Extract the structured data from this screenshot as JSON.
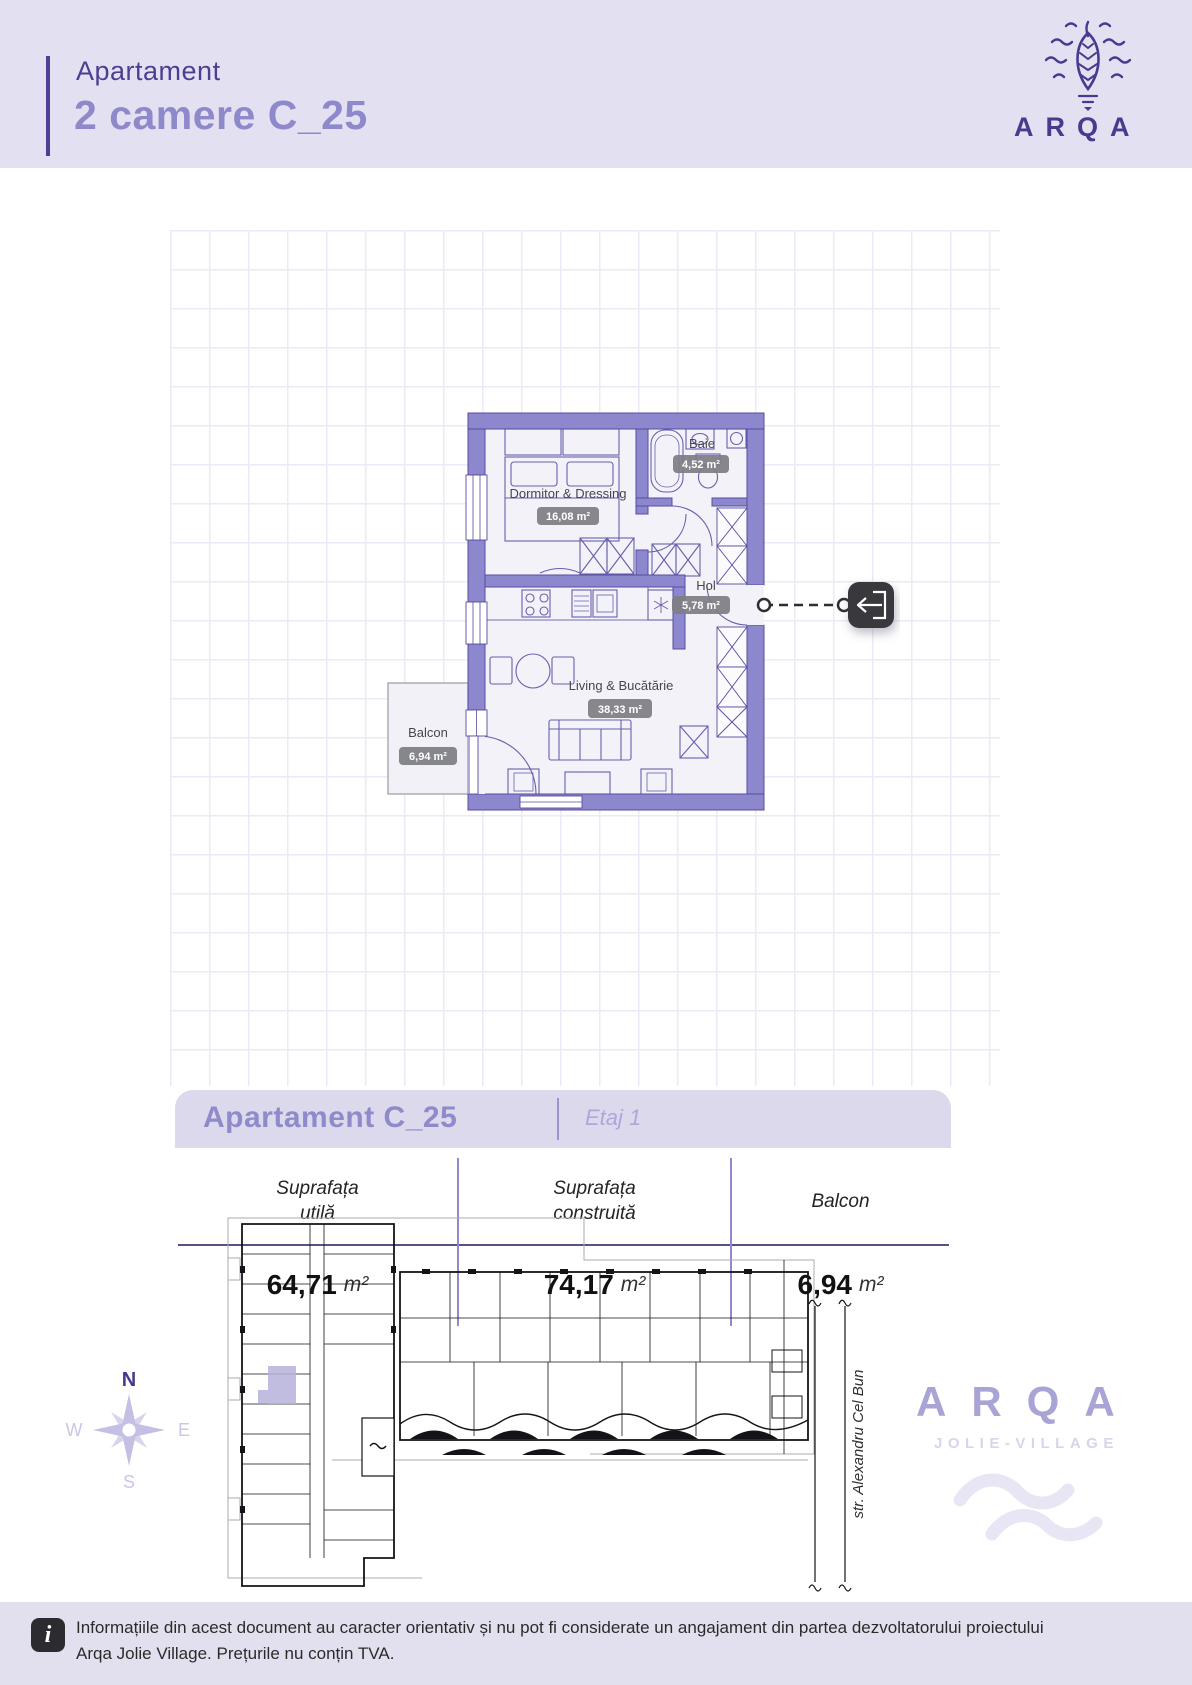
{
  "header": {
    "subtitle": "Apartament",
    "title": "2 camere C_25",
    "brand": "ARQA"
  },
  "floor_plan": {
    "rooms": [
      {
        "name": "Dormitor & Dressing",
        "area": "16,08 m²"
      },
      {
        "name": "Baie",
        "area": "4,52 m²"
      },
      {
        "name": "Hol",
        "area": "5,78 m²"
      },
      {
        "name": "Living & Bucătărie",
        "area": "38,33 m²"
      },
      {
        "name": "Balcon",
        "area": "6,94 m²"
      }
    ]
  },
  "summary": {
    "title": "Apartament C_25",
    "floor": "Etaj 1",
    "columns": [
      {
        "label_line1": "Suprafața",
        "label_line2": "utilă",
        "value": "64,71",
        "unit": "m²"
      },
      {
        "label_line1": "Suprafața",
        "label_line2": "construită",
        "value": "74,17",
        "unit": "m²"
      },
      {
        "label_line1": "Balcon",
        "label_line2": "",
        "value": "6,94",
        "unit": "m²"
      }
    ]
  },
  "site": {
    "street": "str. Alexandru Cel Bun",
    "compass": {
      "north": "N",
      "east": "E",
      "south": "S",
      "west": "W"
    },
    "brand": {
      "name": "ARQA",
      "subtitle": "JOLIE-VILLAGE"
    }
  },
  "footer": {
    "icon": "i",
    "line1": "Informațiile din acest document au caracter orientativ și nu pot fi considerate un angajament din partea dezvoltatorului proiectului",
    "line2": "Arqa Jolie Village. Prețurile nu conțin TVA."
  },
  "colors": {
    "accent_dark": "#4C4094",
    "accent_mid": "#8E89CA",
    "accent_light": "#ACA8D9",
    "wall": "#8D87CE",
    "badge_bg": "#7E7E84",
    "header_bg": "#E3E1F1",
    "footer_bg": "#E2E0EF",
    "highlight": "#B6B2DC"
  }
}
